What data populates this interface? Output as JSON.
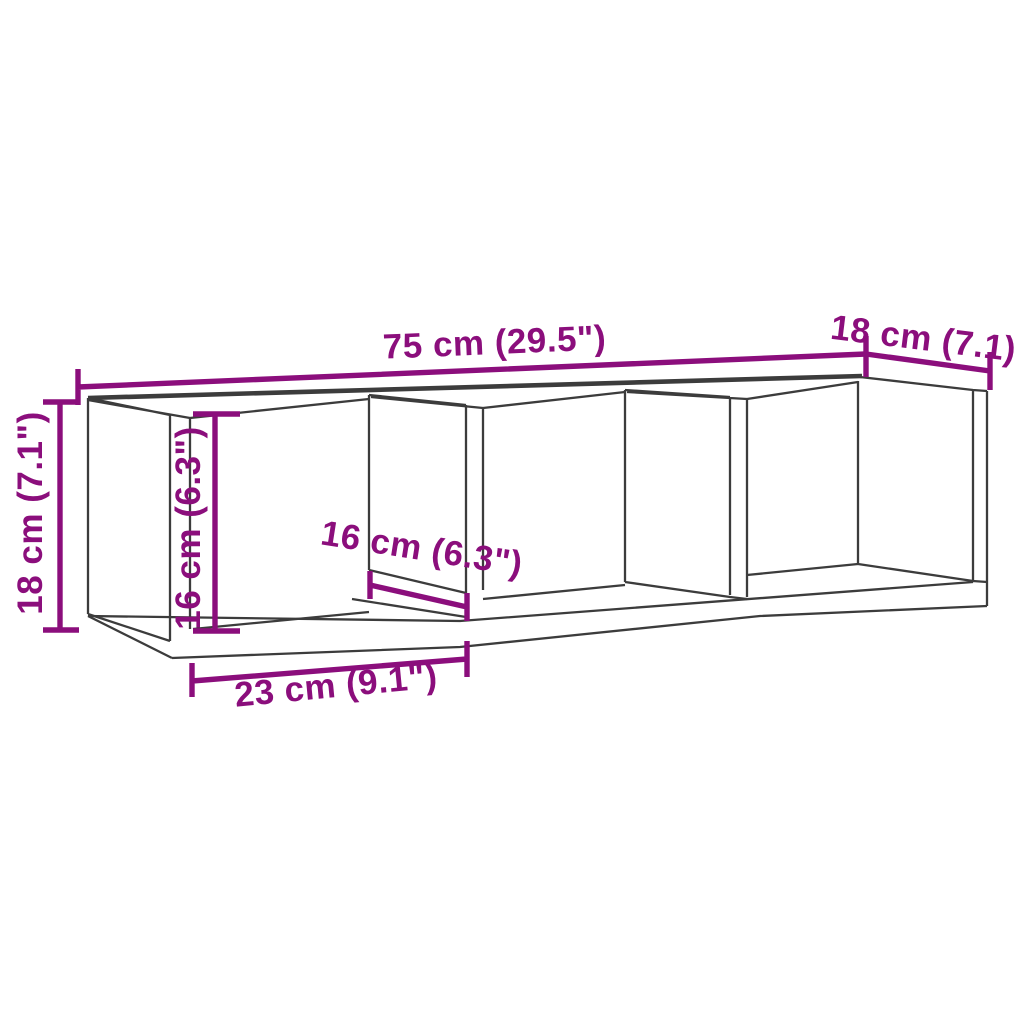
{
  "diagram": {
    "kind": "furniture-dimension-diagram",
    "subject": "wall shelf with 3 open compartments",
    "background_color": "#ffffff",
    "structure_color": "#3c3c3c",
    "dimension_color": "#8b0e7c",
    "dimensions": {
      "overall_width": {
        "label": "75 cm (29.5\")",
        "orientation": "horizontal-top"
      },
      "depth": {
        "label": "18 cm (7.1)",
        "orientation": "diagonal-top-right"
      },
      "overall_height": {
        "label": "18 cm (7.1\")",
        "orientation": "vertical-left"
      },
      "interior_height": {
        "label": "16 cm (6.3\")",
        "orientation": "vertical-inner"
      },
      "interior_width": {
        "label": "16 cm (6.3\")",
        "orientation": "diagonal-middle"
      },
      "compartment_width": {
        "label": "23 cm (9.1\")",
        "orientation": "horizontal-bottom"
      }
    }
  }
}
